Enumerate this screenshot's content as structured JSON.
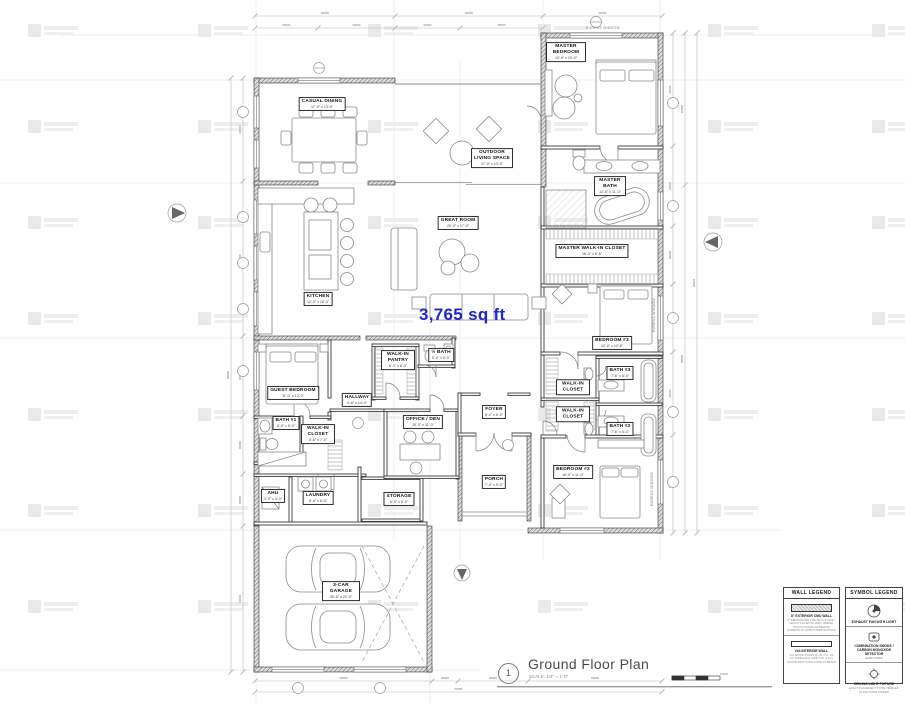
{
  "plan": {
    "area_label": "3,765 sq ft",
    "area_color": "#2026c8",
    "annotations": {
      "egress_top": "EGRESS WINDOW",
      "egress_right_1": "EGRESS WINDOW",
      "egress_right_2": "EGRESS WINDOW"
    }
  },
  "rooms": [
    {
      "id": "casual-dining",
      "name": "CASUAL DINING",
      "dims": "17'-0\" x 13'-0\""
    },
    {
      "id": "outdoor-living",
      "name": "OUTDOOR LIVING SPACE",
      "dims": "17'-0\" x 13'-0\""
    },
    {
      "id": "master-bedroom",
      "name": "MASTER BEDROOM",
      "dims": "13'-6\" x 15'-0\""
    },
    {
      "id": "master-bath",
      "name": "MASTER BATH",
      "dims": "12'-6\" x 11'-0\""
    },
    {
      "id": "great-room",
      "name": "GREAT ROOM",
      "dims": "20'-0\" x 17'-0\""
    },
    {
      "id": "kitchen",
      "name": "KITCHEN",
      "dims": "12'-0\" x 18'-0\""
    },
    {
      "id": "master-wic",
      "name": "MASTER WALK-IN CLOSET",
      "dims": "16'-0\" x 6'-6\""
    },
    {
      "id": "bedroom-3",
      "name": "BEDROOM #3",
      "dims": "12'-0\" x 12'-6\""
    },
    {
      "id": "guest-bedroom",
      "name": "GUEST BEDROOM",
      "dims": "11'-0\" x 12'-0\""
    },
    {
      "id": "walk-in-pantry",
      "name": "WALK-IN PANTRY",
      "dims": "6'-0\" x 8'-0\""
    },
    {
      "id": "half-bath",
      "name": "½ BATH",
      "dims": "5'-0\" x 5'-0\""
    },
    {
      "id": "hallway",
      "name": "HALLWAY",
      "dims": "3'-6\" x 14'-0\""
    },
    {
      "id": "bath-1",
      "name": "BATH #1",
      "dims": "8'-0\" x 5'-0\""
    },
    {
      "id": "wic-guest",
      "name": "WALK-IN CLOSET",
      "dims": "5'-6\" x 7'-0\""
    },
    {
      "id": "office-den",
      "name": "OFFICE / DEN",
      "dims": "10'-0\" x 11'-0\""
    },
    {
      "id": "foyer",
      "name": "FOYER",
      "dims": "8'-0\" x 6'-0\""
    },
    {
      "id": "porch",
      "name": "PORCH",
      "dims": "7'-0\" x 9'-0\""
    },
    {
      "id": "wic-a",
      "name": "WALK-IN CLOSET",
      "dims": ""
    },
    {
      "id": "wic-b",
      "name": "WALK-IN CLOSET",
      "dims": ""
    },
    {
      "id": "bath-3",
      "name": "BATH #3",
      "dims": "7'-6\" x 5'-0\""
    },
    {
      "id": "bath-2",
      "name": "BATH #2",
      "dims": "7'-6\" x 5'-0\""
    },
    {
      "id": "bedroom-2",
      "name": "BEDROOM #2",
      "dims": "16'-0\" x 11'-0\""
    },
    {
      "id": "ahu",
      "name": "AHU",
      "dims": "3'-0\" x 5'-0\""
    },
    {
      "id": "laundry",
      "name": "LAUNDRY",
      "dims": "8'-6\" x 6'-0\""
    },
    {
      "id": "storage",
      "name": "STORAGE",
      "dims": "6'-0\" x 5'-0\""
    },
    {
      "id": "garage",
      "name": "3-CAR GARAGE",
      "dims": "30'-0\" x 22'-0\""
    }
  ],
  "title_block": {
    "number": "1",
    "title": "Ground Floor Plan",
    "scale": "SCALE: 1/4\" = 1'-0\""
  },
  "legends": {
    "wall": {
      "title": "WALL LEGEND",
      "entries": [
        {
          "heading": "8\" EXTERIOR CMU WALL",
          "desc": "8\" REINFORCED CMU BLOCK WALL, GROUT FILLED W/ VERT. REBAR, STUCCO FINISH EXTERIOR, FURRING W/ GWB INTERIOR FINISH"
        },
        {
          "heading": "2x4 INTERIOR WALL",
          "desc": "2x4 WOOD STUDS @ 16\" O.C. W/ 1/2\" GWB EACH SIDE TYP. U.N.O. SOUND BATT INSULATION AT BATHS"
        }
      ]
    },
    "symbol": {
      "title": "SYMBOL LEGEND",
      "entries": [
        {
          "label": "EXHAUST FAN WITH LIGHT",
          "desc": ""
        },
        {
          "label": "COMBINATION SMOKE / CARBON MONOXIDE DETECTOR",
          "desc": "HARD WIRED"
        },
        {
          "label": "CEILING LIGHT FIXTURE",
          "desc": "EXACT PLACEMENT TO BE VERIFIED IN FIELD PER OWNER"
        }
      ]
    }
  }
}
